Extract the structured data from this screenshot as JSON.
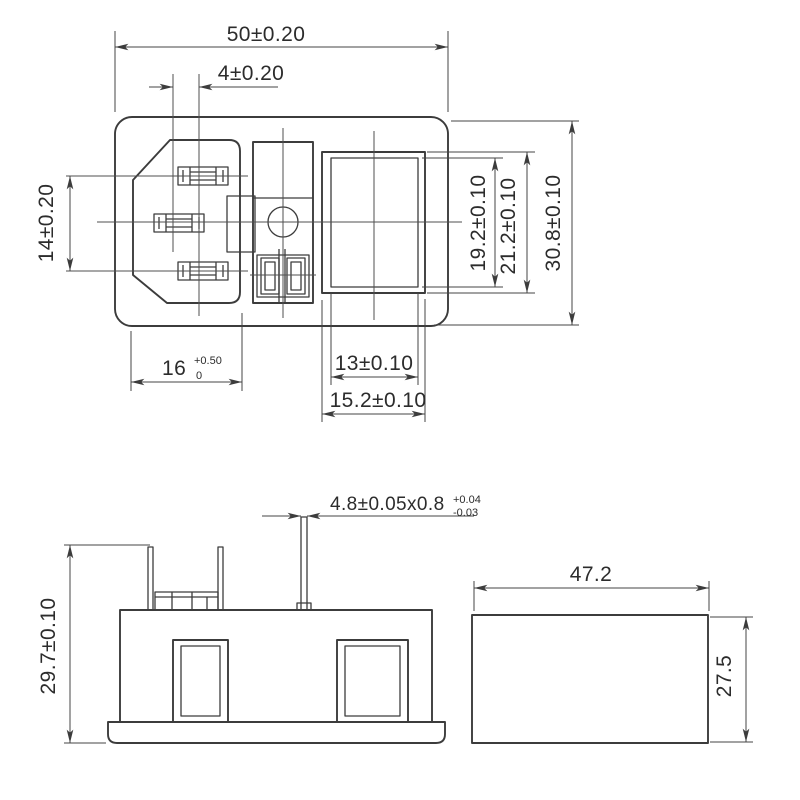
{
  "colors": {
    "background": "#ffffff",
    "line": "#3c3c3c",
    "text": "#2c2c2c"
  },
  "front_view": {
    "dimensions": {
      "overall_width": "50±0.20",
      "terminal_offset": "4±0.20",
      "terminal_spacing": "14±0.20",
      "inlet_opening_width": "16",
      "inlet_opening_tol_upper": "+0.50",
      "inlet_opening_tol_lower": "0",
      "switch_opening_width": "13±0.10",
      "switch_frame_width": "15.2±0.10",
      "switch_opening_height": "19.2±0.10",
      "switch_frame_height": "21.2±0.10",
      "overall_height": "30.8±0.10"
    }
  },
  "side_view": {
    "dimensions": {
      "terminal_cross_section": "4.8±0.05x0.8",
      "terminal_tol_upper": "+0.04",
      "terminal_tol_lower": "-0.03",
      "overall_height": "29.7±0.10"
    }
  },
  "panel_cutout_view": {
    "dimensions": {
      "width": "47.2",
      "height": "27.5"
    }
  }
}
